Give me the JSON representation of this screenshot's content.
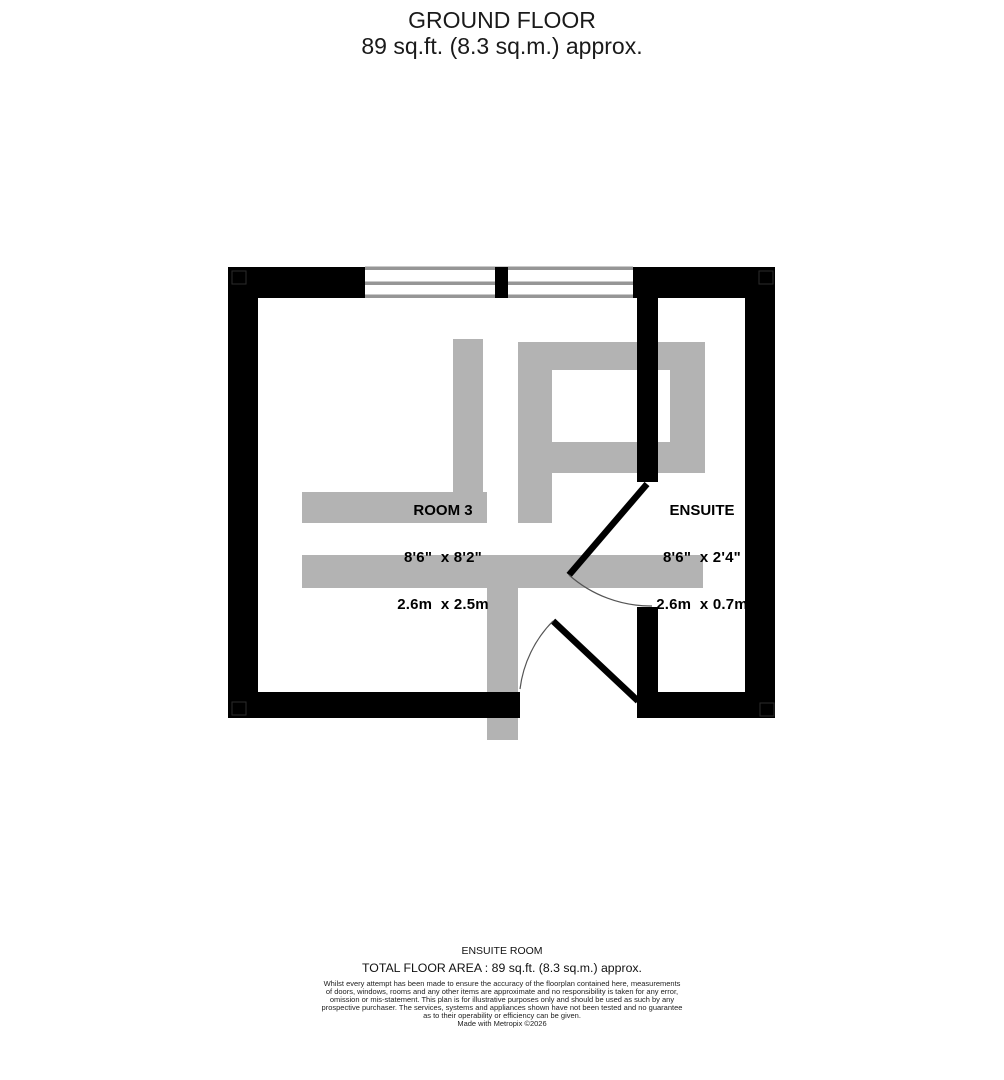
{
  "title": {
    "line1": "GROUND FLOOR",
    "line2": "89 sq.ft. (8.3 sq.m.) approx."
  },
  "floorplan": {
    "rooms": [
      {
        "name": "ROOM 3",
        "size_imperial": "8'6\"  x 8'2\"",
        "size_metric": "2.6m  x 2.5m"
      },
      {
        "name": "ENSUITE",
        "size_imperial": "8'6\"  x 2'4\"",
        "size_metric": "2.6m  x 0.7m"
      }
    ],
    "features": [
      "window",
      "window",
      "door",
      "door",
      "furniture"
    ]
  },
  "footer": {
    "property_name": "ENSUITE ROOM",
    "total_area": "TOTAL FLOOR AREA : 89 sq.ft. (8.3 sq.m.) approx.",
    "disclaimer_lines": [
      "Whilst every attempt has been made to ensure the accuracy of the floorplan contained here, measurements",
      "of doors, windows, rooms and any other items are approximate and no responsibility is taken for any error,",
      "omission or mis-statement. This plan is for illustrative purposes only and should be used as such by any",
      "prospective purchaser. The services, systems and appliances shown have not been tested and no guarantee",
      "as to their operability or efficiency can be given.",
      "Made with Metropix ©2026"
    ]
  },
  "colors": {
    "wall": "#000000",
    "furniture": "#b3b3b3",
    "window_line": "#969696",
    "door_arc": "#555555",
    "title_text": "#1a1a1a",
    "label_text": "#000000"
  }
}
